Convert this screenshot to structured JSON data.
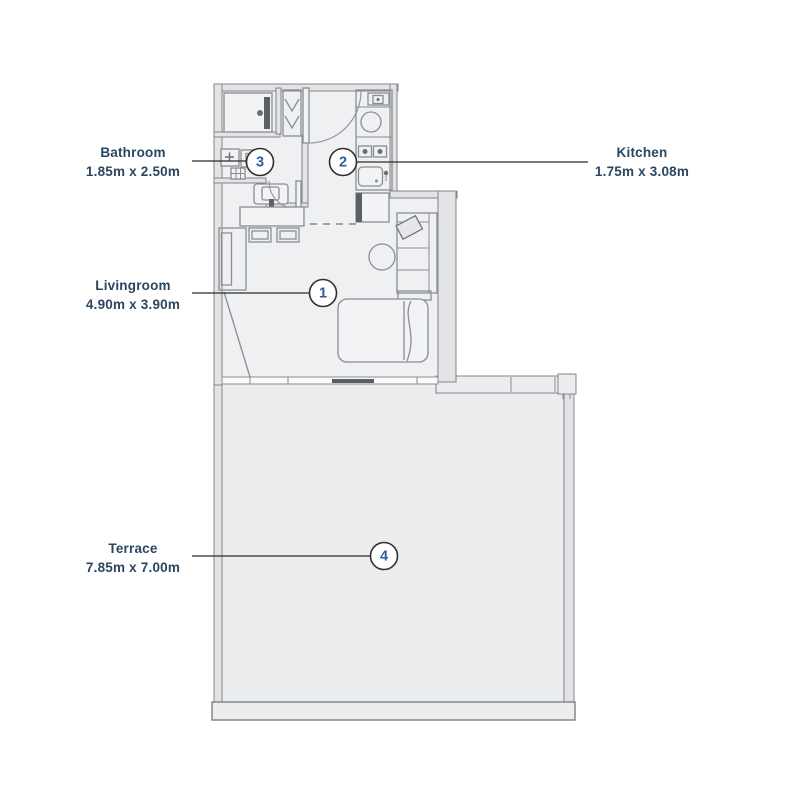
{
  "page": {
    "type": "apartment-floor-plan",
    "background": "#ffffff"
  },
  "colors": {
    "label_text": "#2b4663",
    "marker_number": "#2f5d9e",
    "apartment_floor": "#eef0f2",
    "terrace_floor": "#ebedef",
    "wall_fill": "#e3e4e6",
    "wall_stroke": "#82858a",
    "leader_line": "#2c2c2c"
  },
  "rooms": {
    "livingroom": {
      "marker": "1",
      "name": "Livingroom",
      "dims": "4.90m x 3.90m"
    },
    "kitchen": {
      "marker": "2",
      "name": "Kitchen",
      "dims": "1.75m x 3.08m"
    },
    "bathroom": {
      "marker": "3",
      "name": "Bathroom",
      "dims": "1.85m x 2.50m"
    },
    "terrace": {
      "marker": "4",
      "name": "Terrace",
      "dims": "7.85m x 7.00m"
    }
  }
}
